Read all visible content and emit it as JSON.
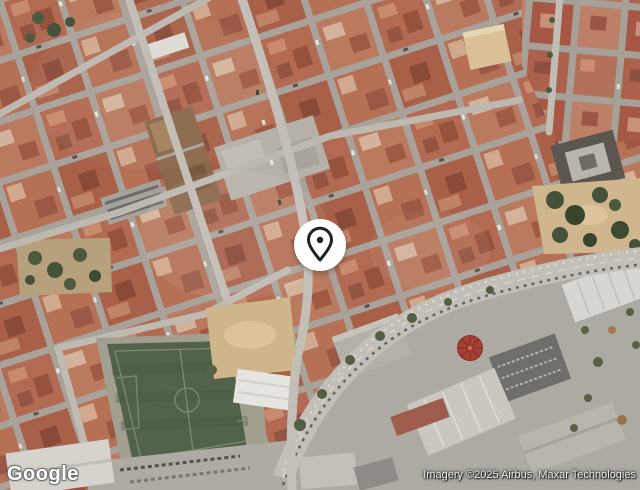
{
  "window": {
    "width": 640,
    "height": 490
  },
  "map": {
    "mode": "satellite",
    "logo": {
      "text": "Google"
    },
    "attribution": {
      "text": "Imagery ©2025 Airbus, Maxar Technologies"
    },
    "marker": {
      "type": "place-pin",
      "description": "white circular badge with dark location-pin outline at map center"
    },
    "colors": {
      "roof_red": "#b26a52",
      "street_gray": "#bdb9b1",
      "field_green": "#53624a",
      "sand_tan": "#cfb58b",
      "avenue_gray": "#c2bfb8",
      "round_roof_red": "#a64035",
      "marker_bg": "#ffffff",
      "marker_glyph": "#202124"
    },
    "features": [
      "dense-red-roofed-city-blocks",
      "diagonal-street-grid",
      "soccer-field",
      "sand-lot",
      "west-park-with-trees",
      "east-park-with-trees",
      "central-plaza",
      "curving-avenue",
      "industrial-warehouse-zone",
      "red-round-roof-building"
    ]
  }
}
